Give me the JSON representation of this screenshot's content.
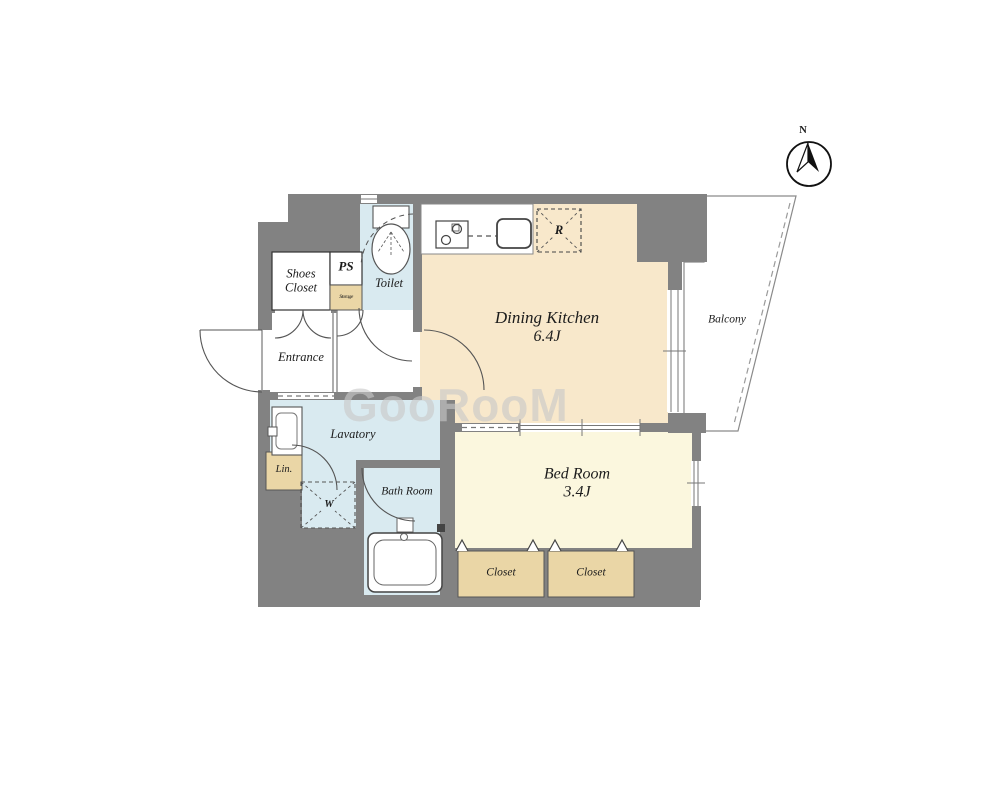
{
  "watermark": "GooRooM",
  "compass": {
    "north_label": "N"
  },
  "rooms": {
    "dining_kitchen": {
      "name": "Dining Kitchen",
      "size": "6.4J"
    },
    "bed_room": {
      "name": "Bed Room",
      "size": "3.4J"
    },
    "balcony": {
      "name": "Balcony"
    },
    "toilet": {
      "name": "Toilet"
    },
    "entrance": {
      "name": "Entrance"
    },
    "lavatory": {
      "name": "Lavatory"
    },
    "bath_room": {
      "name": "Bath Room"
    },
    "shoes_closet": {
      "line1": "Shoes",
      "line2": "Closet"
    },
    "pipe_space": {
      "name": "PS"
    },
    "storage": {
      "name": "Storage"
    },
    "linen": {
      "name": "Lin."
    },
    "closet_left": {
      "name": "Closet"
    },
    "closet_right": {
      "name": "Closet"
    }
  },
  "fixtures": {
    "refrigerator_label": "R",
    "washer_label": "W"
  },
  "colors": {
    "wall": "#828282",
    "dining_kitchen_floor": "#F8E8CB",
    "bed_room_floor": "#FBF7DE",
    "wet_area_floor": "#D9EAF0",
    "closet_fill": "#EAD6A6",
    "watermark": "#C8C8C8"
  }
}
